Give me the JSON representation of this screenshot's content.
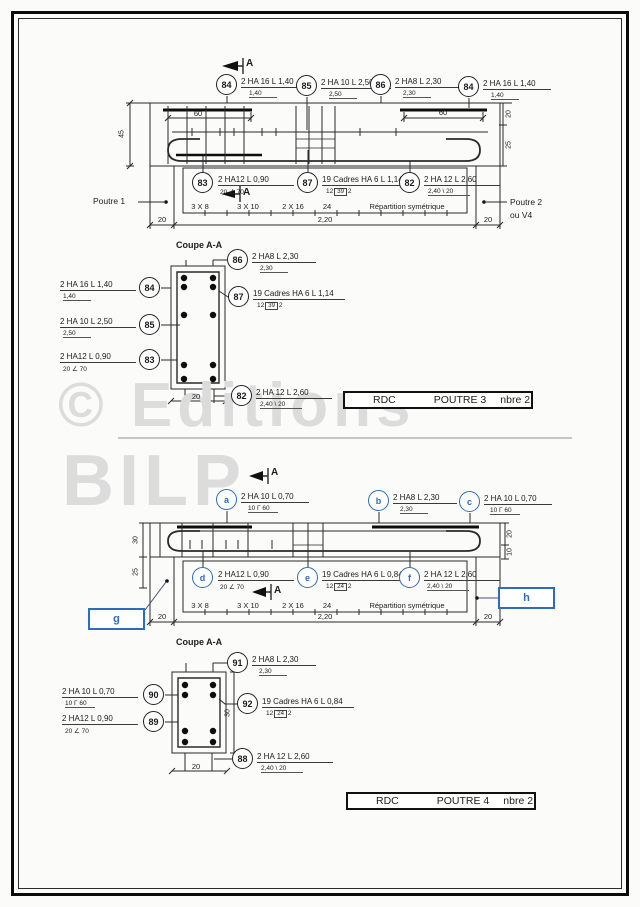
{
  "watermark": {
    "line1": "© Editions",
    "line2": "BILP"
  },
  "p3": {
    "cut_label": "A",
    "callouts_top": [
      {
        "num": "84",
        "label": "2 HA 16 L 1,40",
        "sub": "1,40"
      },
      {
        "num": "85",
        "label": "2 HA 10 L 2,50",
        "sub": "2,50"
      },
      {
        "num": "86",
        "label": "2 HA8 L 2,30",
        "sub": "2,30"
      },
      {
        "num": "84",
        "label": "2 HA 16 L 1,40",
        "sub": "1,40"
      }
    ],
    "callouts_bottom": [
      {
        "num": "83",
        "label": "2 HA12 L 0,90",
        "sub": "20 ∠ 70"
      },
      {
        "num": "87",
        "label": "19 Cadres HA 6 L 1,14",
        "sub_pre": "12",
        "sub_box": "39",
        "sub_post": "2"
      },
      {
        "num": "82",
        "label": "2 HA 12 L 2,60",
        "sub": "2,40 \\ 20"
      }
    ],
    "supports": {
      "left": "Poutre 1",
      "right1": "Poutre 2",
      "right2": "ou V4"
    },
    "dims": {
      "height": "45",
      "sixty": "60",
      "right_top": "20",
      "right_bottom": "25",
      "end": "20",
      "span": "2,20",
      "coupe_width": "20"
    },
    "spacing": [
      "3 X 8",
      "3 X 10",
      "2 X 16",
      "24",
      "Répartition symétrique"
    ],
    "coupe": {
      "title": "Coupe A-A",
      "right": [
        {
          "num": "86",
          "label": "2 HA8 L 2,30",
          "sub": "2,30"
        },
        {
          "num": "87",
          "label": "19 Cadres HA 6 L 1,14",
          "sub_pre": "12",
          "sub_box": "39",
          "sub_post": "2"
        },
        {
          "num": "82",
          "label": "2 HA 12 L 2,60",
          "sub": "2,40 \\ 20"
        }
      ],
      "left": [
        {
          "num": "84",
          "label": "2 HA 16 L 1,40",
          "sub": "1,40"
        },
        {
          "num": "85",
          "label": "2 HA 10 L 2,50",
          "sub": "2,50"
        },
        {
          "num": "83",
          "label": "2 HA12 L 0,90",
          "sub": "20 ∠ 70"
        }
      ]
    },
    "titleblock": {
      "c1": "RDC",
      "c2": "POUTRE 3",
      "c3": "nbre 2"
    }
  },
  "p4": {
    "cut_label": "A",
    "callouts_top": [
      {
        "num": "a",
        "label": "2 HA 10 L 0,70",
        "sub": "10 Γ 60"
      },
      {
        "num": "b",
        "label": "2 HA8 L 2,30",
        "sub": "2,30"
      },
      {
        "num": "c",
        "label": "2 HA 10 L 0,70",
        "sub": "10 Γ 60"
      }
    ],
    "callouts_bottom": [
      {
        "num": "d",
        "label": "2 HA12 L 0,90",
        "sub": "20 ∠ 70"
      },
      {
        "num": "e",
        "label": "19 Cadres HA 6 L 0,84",
        "sub_pre": "12",
        "sub_box": "24",
        "sub_post": "2"
      },
      {
        "num": "f",
        "label": "2 HA 12 L 2,60",
        "sub": "2,40 \\ 20"
      }
    ],
    "refs": {
      "left": "g",
      "right": "h"
    },
    "dims": {
      "height": "30",
      "below": "25",
      "right_top": "20",
      "right_bottom": "10",
      "end": "20",
      "span": "2,20",
      "coupe_width": "20",
      "coupe_height": "30"
    },
    "spacing": [
      "3 X 8",
      "3 X 10",
      "2 X 16",
      "24",
      "Répartition symétrique"
    ],
    "coupe": {
      "title": "Coupe A-A",
      "right": [
        {
          "num": "91",
          "label": "2 HA8 L 2,30",
          "sub": "2,30"
        },
        {
          "num": "92",
          "label": "19 Cadres HA 6 L 0,84",
          "sub_pre": "12",
          "sub_box": "24",
          "sub_post": "2"
        },
        {
          "num": "88",
          "label": "2 HA 12 L 2,60",
          "sub": "2,40 \\ 20"
        }
      ],
      "left": [
        {
          "num": "90",
          "label": "2 HA 10 L 0,70",
          "sub": "10 Γ 60"
        },
        {
          "num": "89",
          "label": "2 HA12 L 0,90",
          "sub": "20 ∠ 70"
        }
      ]
    },
    "titleblock": {
      "c1": "RDC",
      "c2": "POUTRE 4",
      "c3": "nbre 2"
    }
  }
}
